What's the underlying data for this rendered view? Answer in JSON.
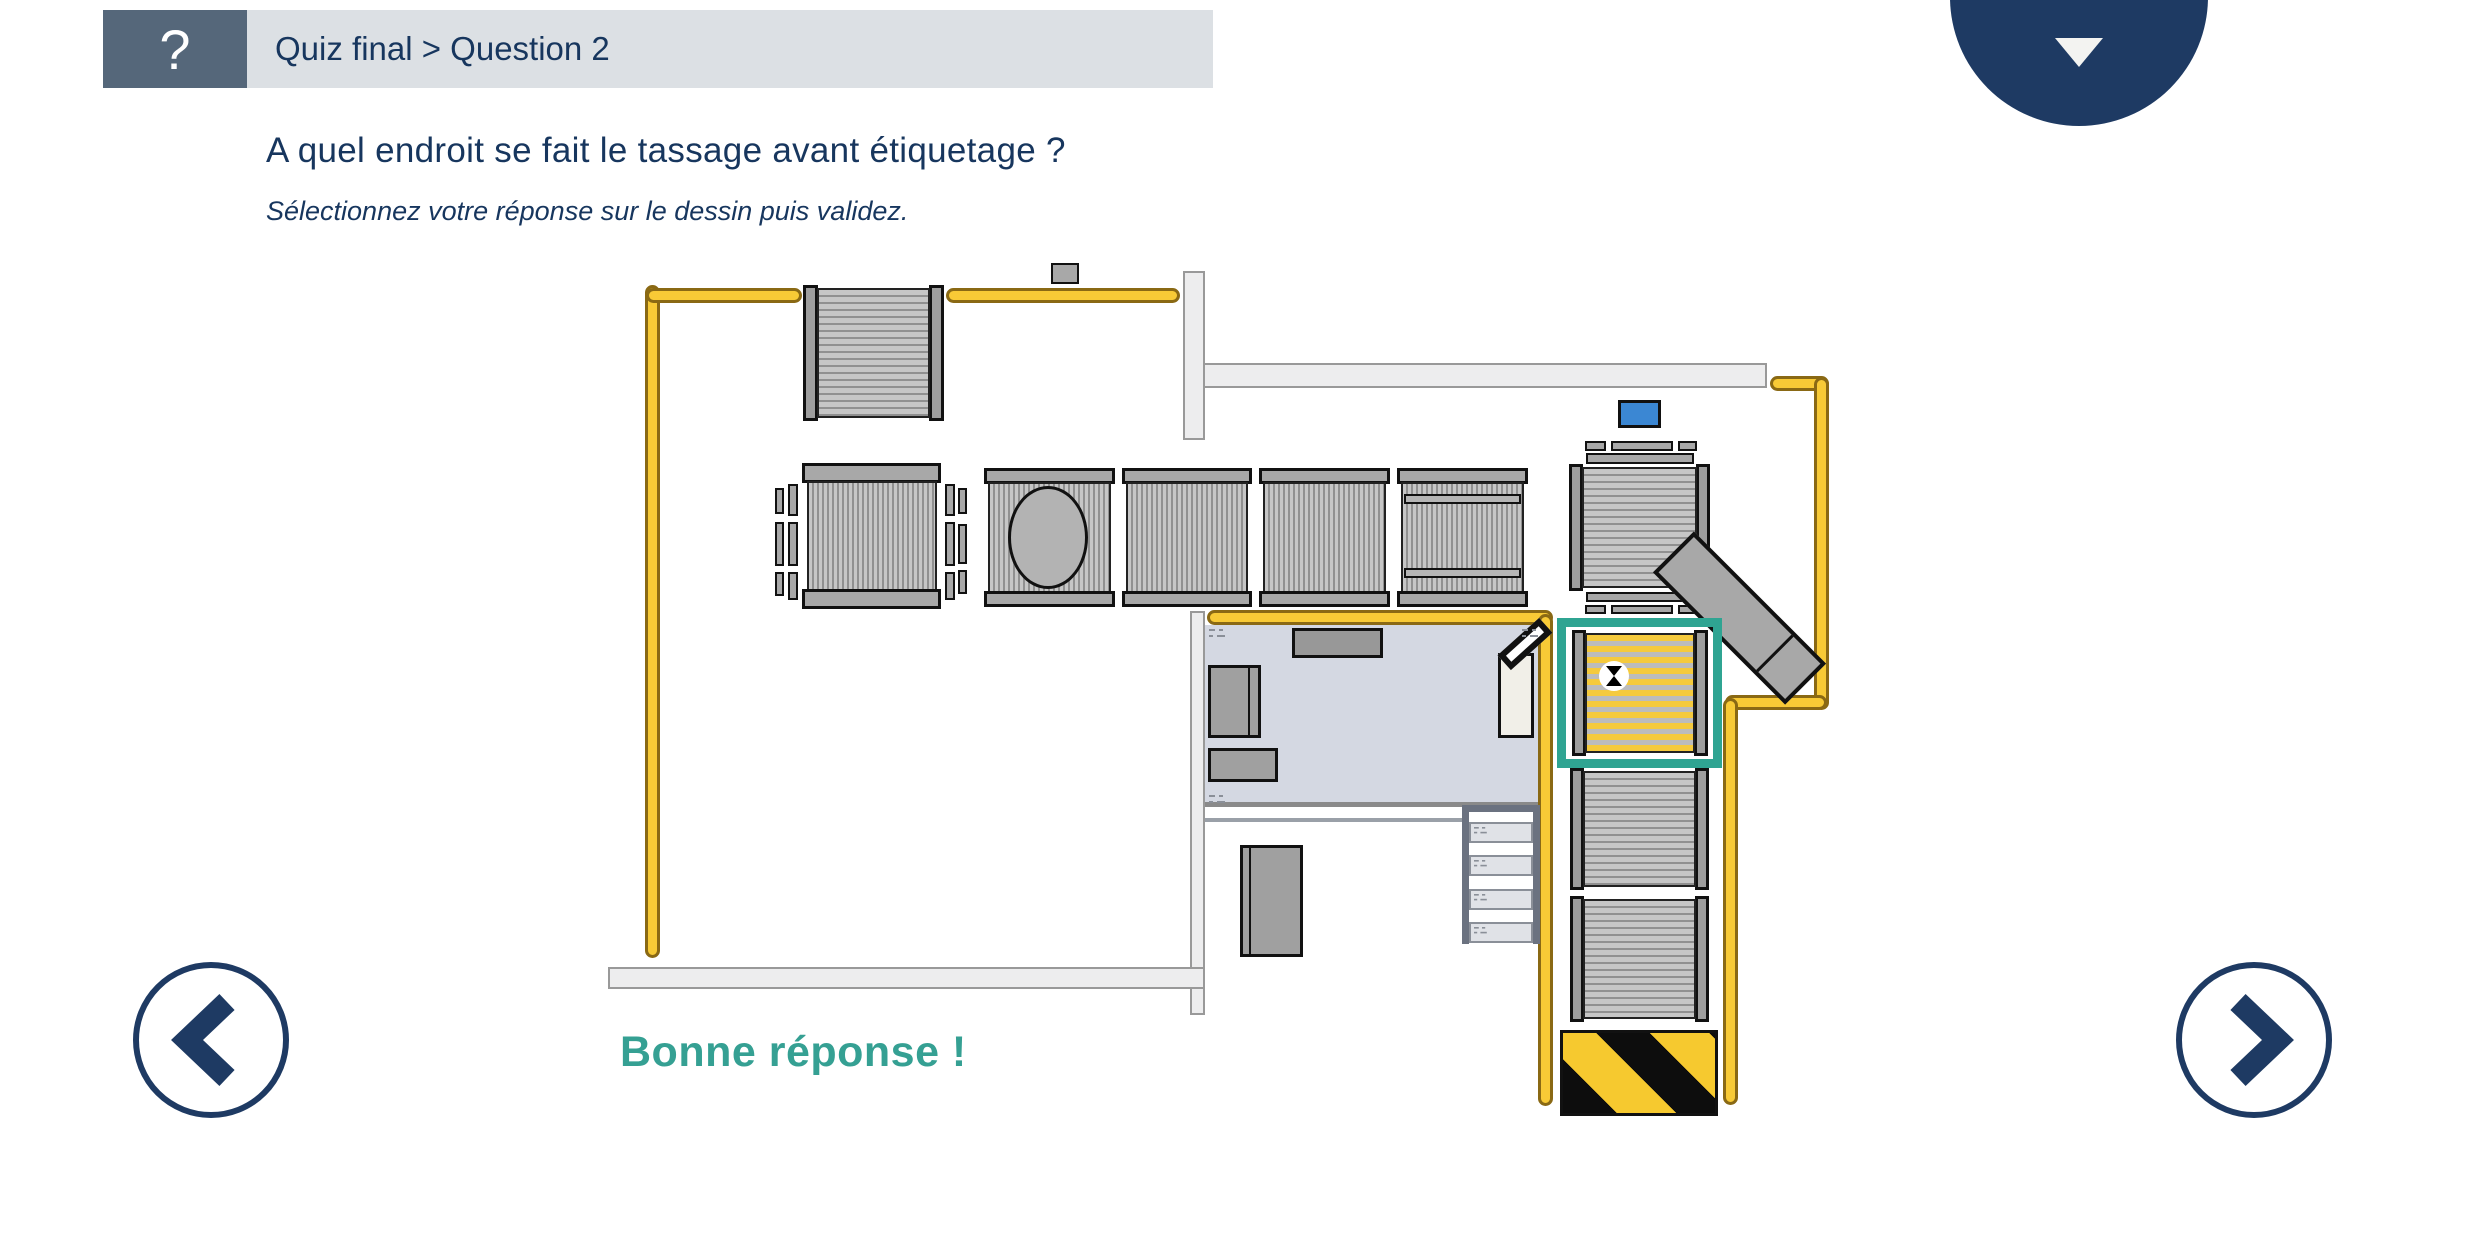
{
  "header": {
    "help_label": "?",
    "breadcrumb": "Quiz final > Question 2"
  },
  "menu": {
    "caret_icon": "chevron-down"
  },
  "question": {
    "title": "A quel endroit se fait le tassage avant étiquetage ?",
    "instruction": "Sélectionnez votre réponse sur le dessin puis validez."
  },
  "feedback": {
    "text": "Bonne réponse !",
    "state": "correct"
  },
  "nav": {
    "prev_label": "<",
    "next_label": ">"
  },
  "diagram": {
    "selected_answer": "tassage-zone",
    "cursor_icon": "hourglass-busy",
    "elements": [
      "guardrails",
      "infeed-conveyor",
      "turntable",
      "line-conveyors",
      "labeller",
      "vertical-conveyors",
      "tilted-conveyor",
      "control-room",
      "stairs",
      "hazard-strip",
      "pallet-station"
    ]
  },
  "colors": {
    "navy": "#1e3a63",
    "navy_text": "#17365e",
    "slate": "#55677a",
    "header_bg": "#dce0e4",
    "teal": "#2fa492",
    "teal_text": "#35a093",
    "yellow": "#f8ca36",
    "yellow_border": "#8a6914",
    "belt_light": "#c6c6c6",
    "belt_dark": "#909090",
    "cap": "#a8a8a8",
    "rail": "#9e9e9e",
    "room": "#d4d8e2",
    "wall_fill": "#ededee",
    "wall_border": "#999999",
    "blue": "#3b87d3",
    "hazard_yellow": "#f6c92f",
    "stair": "#6b7280",
    "step": "#e0e2e7",
    "ink": "#111111"
  }
}
